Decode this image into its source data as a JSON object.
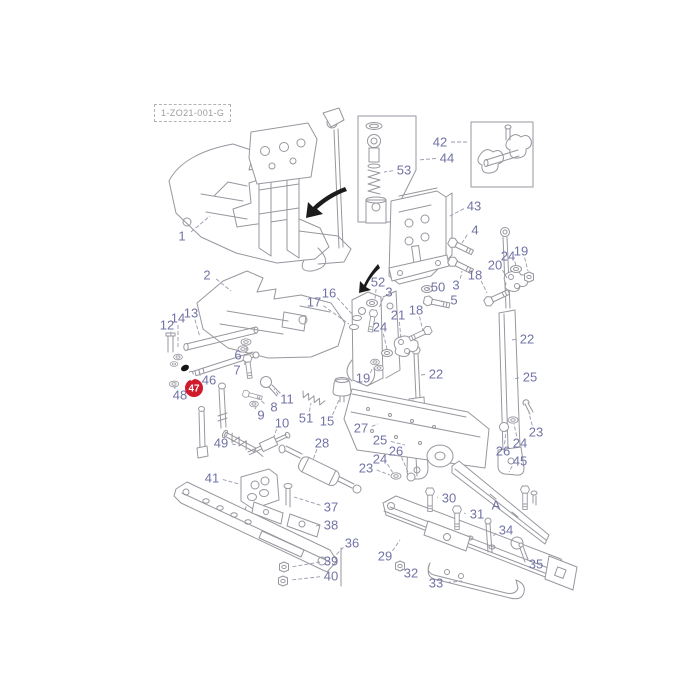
{
  "diagram": {
    "code": "1-ZO21-001-G",
    "colors": {
      "label": "#7173a6",
      "line": "#97979f",
      "leader": "#9a9aae",
      "arrow": "#1c1c1c",
      "highlight": "#cf1b2b",
      "highlight_text": "#ffffff",
      "background": "#ffffff"
    },
    "highlight": {
      "part": "47",
      "x": 194,
      "y": 388,
      "r": 9,
      "pointer": "186,371 191,381 198,377"
    },
    "labels": [
      {
        "t": "1",
        "x": 182,
        "y": 236,
        "lx": 210,
        "ly": 216
      },
      {
        "t": "2",
        "x": 207,
        "y": 275,
        "lx": 231,
        "ly": 291
      },
      {
        "t": "3",
        "x": 456,
        "y": 285,
        "lx": 462,
        "ly": 271
      },
      {
        "t": "3",
        "x": 389,
        "y": 292,
        "lx": 379,
        "ly": 308
      },
      {
        "t": "4",
        "x": 475,
        "y": 230,
        "lx": 462,
        "ly": 243
      },
      {
        "t": "5",
        "x": 454,
        "y": 300,
        "lx": 441,
        "ly": 302
      },
      {
        "t": "6",
        "x": 238,
        "y": 355,
        "lx": 247,
        "ly": 347
      },
      {
        "t": "7",
        "x": 237,
        "y": 370,
        "lx": 246,
        "ly": 360
      },
      {
        "t": "8",
        "x": 274,
        "y": 407,
        "lx": 258,
        "ly": 398
      },
      {
        "t": "9",
        "x": 261,
        "y": 415,
        "lx": 256,
        "ly": 407
      },
      {
        "t": "10",
        "x": 282,
        "y": 423,
        "lx": 274,
        "ly": 437
      },
      {
        "t": "11",
        "x": 287,
        "y": 399,
        "lx": 274,
        "ly": 389
      },
      {
        "t": "12",
        "x": 167,
        "y": 325,
        "lx": 171,
        "ly": 336
      },
      {
        "t": "13",
        "x": 191,
        "y": 313,
        "lx": 200,
        "ly": 337
      },
      {
        "t": "14",
        "x": 178,
        "y": 318,
        "lx": 178,
        "ly": 348
      },
      {
        "t": "15",
        "x": 327,
        "y": 421,
        "lx": 339,
        "ly": 400
      },
      {
        "t": "16",
        "x": 329,
        "y": 293,
        "lx": 352,
        "ly": 314
      },
      {
        "t": "17",
        "x": 314,
        "y": 302,
        "lx": 349,
        "ly": 324
      },
      {
        "t": "18",
        "x": 475,
        "y": 275,
        "lx": 487,
        "ly": 293
      },
      {
        "t": "18",
        "x": 416,
        "y": 310,
        "lx": 423,
        "ly": 331
      },
      {
        "t": "19",
        "x": 521,
        "y": 251,
        "lx": 528,
        "ly": 271
      },
      {
        "t": "19",
        "x": 363,
        "y": 378,
        "lx": 373,
        "ly": 367
      },
      {
        "t": "20",
        "x": 495,
        "y": 265,
        "lx": 507,
        "ly": 278
      },
      {
        "t": "21",
        "x": 398,
        "y": 315,
        "lx": 401,
        "ly": 339
      },
      {
        "t": "22",
        "x": 527,
        "y": 339,
        "lx": 511,
        "ly": 340
      },
      {
        "t": "22",
        "x": 436,
        "y": 374,
        "lx": 421,
        "ly": 375
      },
      {
        "t": "23",
        "x": 536,
        "y": 432,
        "lx": 529,
        "ly": 413
      },
      {
        "t": "23",
        "x": 366,
        "y": 468,
        "lx": 390,
        "ly": 475
      },
      {
        "t": "24",
        "x": 508,
        "y": 256,
        "lx": 516,
        "ly": 266
      },
      {
        "t": "24",
        "x": 380,
        "y": 327,
        "lx": 387,
        "ly": 349
      },
      {
        "t": "24",
        "x": 520,
        "y": 443,
        "lx": 514,
        "ly": 424
      },
      {
        "t": "24",
        "x": 380,
        "y": 459,
        "lx": 393,
        "ly": 473
      },
      {
        "t": "25",
        "x": 530,
        "y": 377,
        "lx": 513,
        "ly": 379
      },
      {
        "t": "25",
        "x": 380,
        "y": 440,
        "lx": 405,
        "ly": 445
      },
      {
        "t": "26",
        "x": 503,
        "y": 451,
        "lx": 506,
        "ly": 430
      },
      {
        "t": "26",
        "x": 396,
        "y": 451,
        "lx": 408,
        "ly": 472
      },
      {
        "t": "27",
        "x": 361,
        "y": 428,
        "lx": 378,
        "ly": 424
      },
      {
        "t": "28",
        "x": 322,
        "y": 443,
        "lx": 313,
        "ly": 460
      },
      {
        "t": "29",
        "x": 385,
        "y": 556,
        "lx": 400,
        "ly": 540
      },
      {
        "t": "30",
        "x": 449,
        "y": 498,
        "lx": 437,
        "ly": 497
      },
      {
        "t": "31",
        "x": 477,
        "y": 514,
        "lx": 464,
        "ly": 513
      },
      {
        "t": "32",
        "x": 411,
        "y": 573,
        "lx": 403,
        "ly": 569
      },
      {
        "t": "33",
        "x": 436,
        "y": 583,
        "lx": 462,
        "ly": 581
      },
      {
        "t": "34",
        "x": 506,
        "y": 530,
        "lx": 492,
        "ly": 537
      },
      {
        "t": "35",
        "x": 536,
        "y": 564,
        "lx": 525,
        "ly": 553
      },
      {
        "t": "36",
        "x": 352,
        "y": 543,
        "lx": 333,
        "ly": 558
      },
      {
        "t": "37",
        "x": 331,
        "y": 507,
        "lx": 294,
        "ly": 497
      },
      {
        "t": "38",
        "x": 331,
        "y": 525,
        "lx": 315,
        "ly": 526
      },
      {
        "t": "39",
        "x": 331,
        "y": 561,
        "lx": 291,
        "ly": 567
      },
      {
        "t": "40",
        "x": 331,
        "y": 576,
        "lx": 291,
        "ly": 580
      },
      {
        "t": "41",
        "x": 212,
        "y": 478,
        "lx": 239,
        "ly": 484
      },
      {
        "t": "42",
        "x": 440,
        "y": 142,
        "lx": 469,
        "ly": 142
      },
      {
        "t": "43",
        "x": 474,
        "y": 206,
        "lx": 448,
        "ly": 217
      },
      {
        "t": "44",
        "x": 447,
        "y": 158,
        "lx": 418,
        "ly": 160
      },
      {
        "t": "45",
        "x": 520,
        "y": 461,
        "lx": 509,
        "ly": 472
      },
      {
        "t": "46",
        "x": 209,
        "y": 380,
        "lx": 199,
        "ly": 372
      },
      {
        "t": "48",
        "x": 180,
        "y": 395,
        "lx": 175,
        "ly": 386
      },
      {
        "t": "49",
        "x": 221,
        "y": 443,
        "lx": 237,
        "ly": 445
      },
      {
        "t": "50",
        "x": 438,
        "y": 287,
        "lx": 430,
        "ly": 289
      },
      {
        "t": "51",
        "x": 306,
        "y": 418,
        "lx": 311,
        "ly": 403
      },
      {
        "t": "52",
        "x": 378,
        "y": 282,
        "lx": 375,
        "ly": 299
      },
      {
        "t": "53",
        "x": 404,
        "y": 170,
        "lx": 384,
        "ly": 172
      },
      {
        "t": "A",
        "x": 496,
        "y": 505
      }
    ]
  }
}
